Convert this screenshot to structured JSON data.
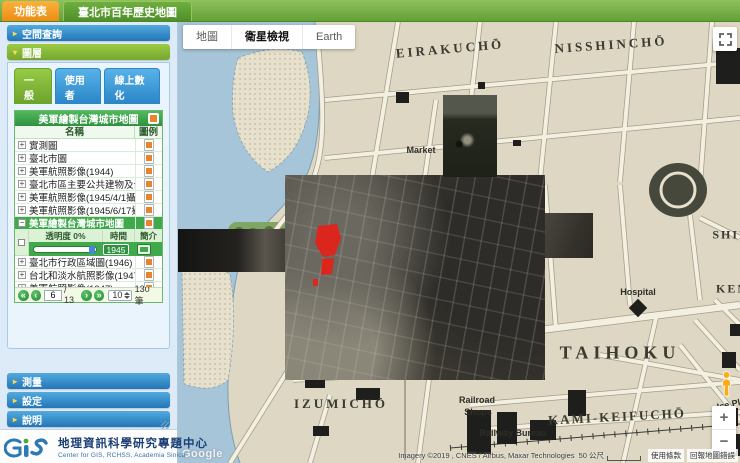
{
  "topbar": {
    "menu_tab": "功能表",
    "title": "臺北市百年歷史地圖"
  },
  "icons": {
    "section_collapsed": "▸",
    "section_expanded": "▾",
    "expand": "+",
    "collapse": "−",
    "first_page": "«",
    "prev_page": "‹",
    "next_page": "›",
    "last_page": "»",
    "zoom_in": "+",
    "zoom_out": "−"
  },
  "sidebar": {
    "sections": [
      {
        "label": "空間查詢"
      },
      {
        "label": "圖層"
      },
      {
        "label": "測量"
      },
      {
        "label": "設定"
      },
      {
        "label": "說明"
      }
    ],
    "tabs": [
      {
        "label": "一般",
        "active": true
      },
      {
        "label": "使用者",
        "active": false
      },
      {
        "label": "線上數化",
        "active": false
      }
    ],
    "layer_panel": {
      "group_title": "美軍繪製台灣城市地圖",
      "columns": {
        "name": "名稱",
        "legend": "圖例"
      },
      "rows": [
        {
          "name": "實測圖"
        },
        {
          "name": "臺北市圖"
        },
        {
          "name": "美軍航照影像(1944)"
        },
        {
          "name": "臺北市區主要公共建物及公園"
        },
        {
          "name": "美軍航照影像(1945/4/1攝)"
        },
        {
          "name": "美軍航照影像(1945/6/17攝)"
        },
        {
          "name": "美軍繪製台灣城市地圖",
          "selected": true,
          "expanded": true
        },
        {
          "name": "臺北市行政區域圖(1946)"
        },
        {
          "name": "台北和淡水航照影像(1947)"
        },
        {
          "name": "美軍航照影像(1947)"
        }
      ],
      "detail": {
        "opacity_label": "透明度 0%",
        "time_label": "時間",
        "intro_label": "簡介",
        "year_value": "1945"
      },
      "pagination": {
        "page": "6",
        "total_pages": "/ 13",
        "page_size": "10",
        "records": "130 筆"
      }
    },
    "logo": {
      "org_zh": "地理資訊科學研究專題中心",
      "org_en": "Center for GIS, RCHSS, Academia Sinica"
    }
  },
  "map": {
    "view_tabs": [
      {
        "label": "地圖",
        "active": false
      },
      {
        "label": "衛星檢視",
        "active": true
      },
      {
        "label": "Earth",
        "active": false
      }
    ],
    "labels": [
      {
        "text": "EIRAKUCHŌ",
        "x": 272,
        "y": 27,
        "size": 13,
        "ls": 3,
        "cls": "big",
        "rot": -5
      },
      {
        "text": "NISSHINCHŌ",
        "x": 433,
        "y": 23,
        "size": 13,
        "ls": 3,
        "cls": "big",
        "rot": -4
      },
      {
        "text": "Market",
        "x": 243,
        "y": 128,
        "size": 9,
        "ls": 0,
        "cls": "small",
        "rot": 0
      },
      {
        "text": "SHIN",
        "x": 553,
        "y": 213,
        "size": 12,
        "ls": 2,
        "cls": "big",
        "rot": 0
      },
      {
        "text": "KEN",
        "x": 554,
        "y": 267,
        "size": 12,
        "ls": 2,
        "cls": "big",
        "rot": 0
      },
      {
        "text": "Hospital",
        "x": 460,
        "y": 270,
        "size": 9,
        "ls": 0,
        "cls": "small",
        "rot": 0
      },
      {
        "text": "TAIHOKU",
        "x": 442,
        "y": 331,
        "size": 18,
        "ls": 5,
        "cls": "big",
        "rot": 0
      },
      {
        "text": "IZUMICHŌ",
        "x": 163,
        "y": 382,
        "size": 13,
        "ls": 3,
        "cls": "big",
        "rot": 0
      },
      {
        "text": "Railroad",
        "x": 299,
        "y": 378,
        "size": 9,
        "ls": 0,
        "cls": "small",
        "rot": 0
      },
      {
        "text": "Shops",
        "x": 300,
        "y": 390,
        "size": 9,
        "ls": 0,
        "cls": "small",
        "rot": 0
      },
      {
        "text": "Railway Bureau",
        "x": 335,
        "y": 411,
        "size": 9,
        "ls": 0,
        "cls": "small",
        "rot": 0
      },
      {
        "text": "KAMI-KEIFUCHŌ",
        "x": 439,
        "y": 395,
        "size": 13,
        "ls": 2,
        "cls": "big",
        "rot": -3
      },
      {
        "text": "Ice Pla",
        "x": 553,
        "y": 382,
        "size": 9,
        "ls": 0,
        "cls": "small",
        "rot": -12
      }
    ],
    "watermark": "Google",
    "attribution": "Imagery ©2019 , CNES / Airbus, Maxar Technologies",
    "scale_text": "50 公尺",
    "terms_link": "使用條款",
    "report_link": "回報地圖錯誤"
  }
}
